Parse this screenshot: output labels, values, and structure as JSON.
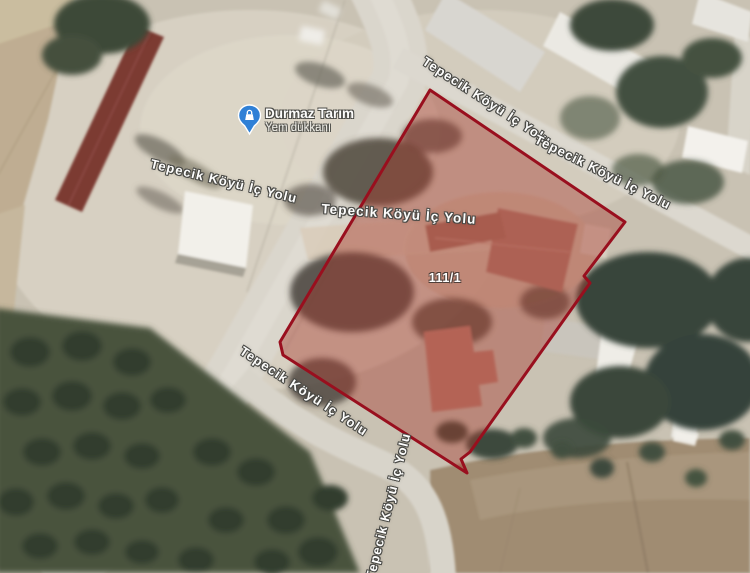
{
  "map": {
    "view": "satellite",
    "poi": {
      "name": "Durmaz Tarım",
      "subtitle": "Yem dükkanı",
      "pin_color": "#2f80d6",
      "icon": "store-pin"
    },
    "parcel": {
      "number": "111/1",
      "stroke_color": "#990f1e",
      "fill_color": "#a63a2e"
    },
    "road_labels": [
      {
        "text": "Tepecik Köyü İç Yolu"
      },
      {
        "text": "Tepecik Köyü İç Yolu"
      },
      {
        "text": "Tepecik Köyü İç Yolu"
      },
      {
        "text": "Tepecik Köyü İç Yolu"
      },
      {
        "text": "Tepecik Köyü İç Yolu"
      },
      {
        "text": "Tepecik Köyü İç Yolu"
      }
    ]
  }
}
